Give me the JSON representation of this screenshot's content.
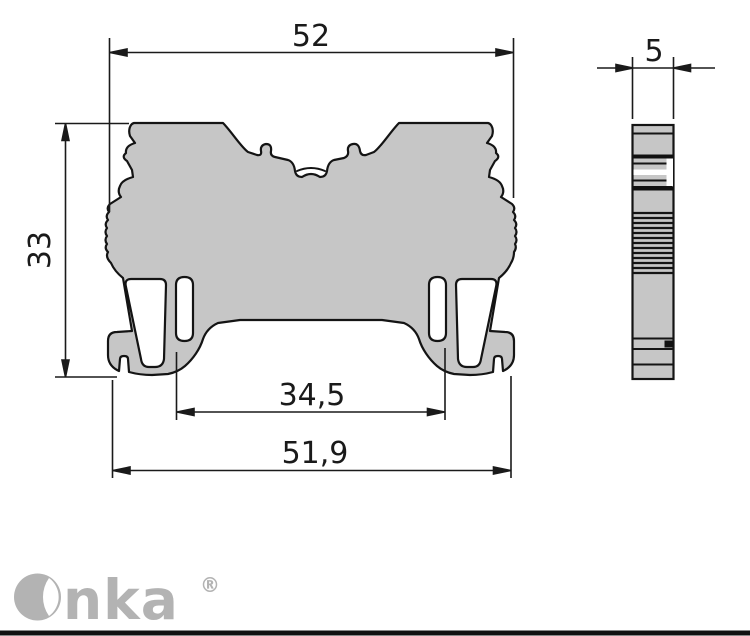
{
  "drawing": {
    "dimensions": {
      "top_width": "52",
      "height": "33",
      "inner_width": "34,5",
      "bottom_width": "51,9",
      "thickness": "5"
    },
    "colors": {
      "part_fill": "#c6c6c6",
      "outline": "#141414",
      "dimension_line": "#1a1a1a",
      "logo_gray": "#b3b3b3",
      "footer_bar": "#111111"
    }
  },
  "footer": {
    "brand": "Onka",
    "brand_text_after_mark": "nka",
    "registered": "®"
  }
}
